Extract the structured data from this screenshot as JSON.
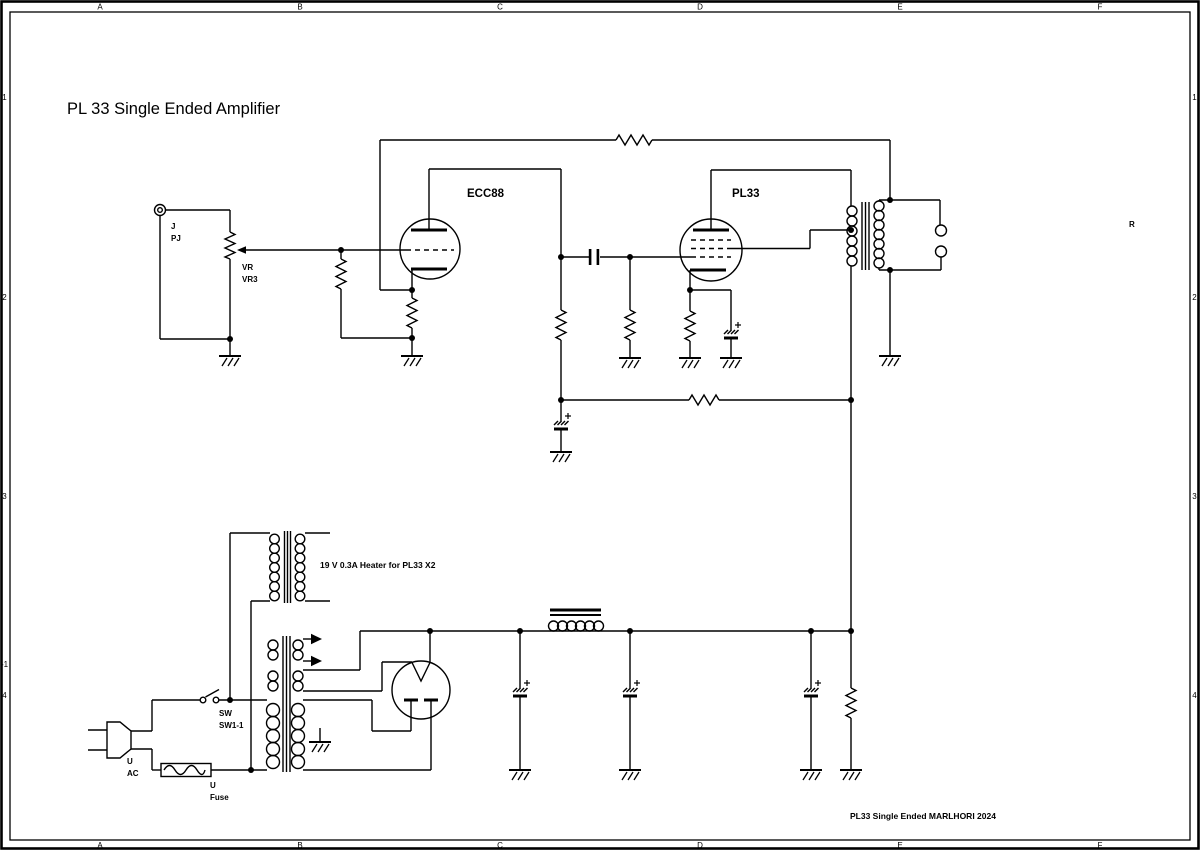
{
  "title": "PL 33 Single Ended Amplifier",
  "frame": {
    "cols": [
      "A",
      "B",
      "C",
      "D",
      "E",
      "F"
    ],
    "rows": [
      "1",
      "2",
      "3",
      "4"
    ],
    "row_extra": "-1",
    "side_note": "R"
  },
  "labels": {
    "jack_ref": "J",
    "jack_name": "PJ",
    "pot_ref": "VR",
    "pot_name": "VR3",
    "v1": "ECC88",
    "v2": "PL33",
    "sw_ref": "SW",
    "sw_name": "SW1-1",
    "mains_ref": "U",
    "mains_name": "AC",
    "fuse_ref": "U",
    "fuse_name": "Fuse",
    "heater_note": "19 V 0.3A Heater for PL33 X2",
    "footer": "PL33 Single Ended  MARLHORI 2024"
  },
  "colors": {
    "ink": "#000000",
    "paper": "#ffffff"
  }
}
